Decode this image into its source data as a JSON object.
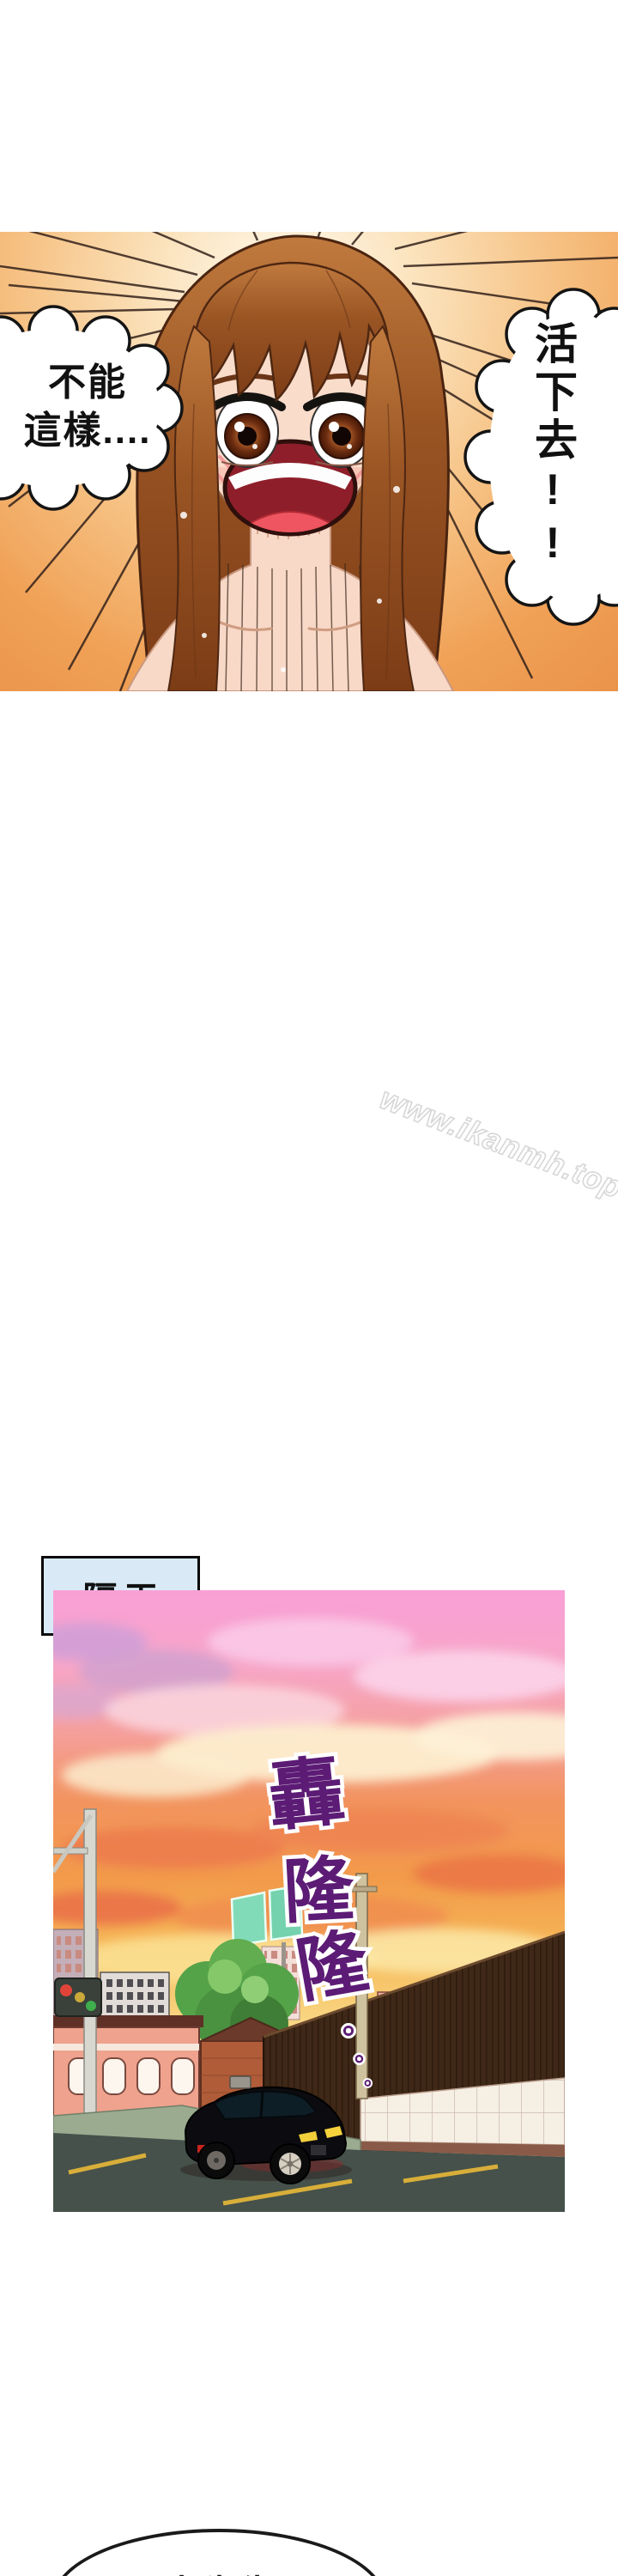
{
  "page": {
    "background": "#ffffff",
    "watermark": "www.ikanmh.top"
  },
  "panel1": {
    "speech_left_line1": "不能",
    "speech_left_line2": "這樣....",
    "speech_right": "活下去!!"
  },
  "scene_label": "隔天",
  "panel2": {
    "sfx_chars": [
      "轟",
      "隆",
      "隆"
    ],
    "sfx_dots": [
      "。",
      "。",
      "。"
    ]
  },
  "bottom_bubble": {
    "text": "王大先生..."
  },
  "colors": {
    "burst_orange": "#f0a156",
    "sky_pink": "#f99fd6",
    "sunset_orange": "#f2945f",
    "sunset_yellow": "#fbe092",
    "sfx_purple": "#5c1b75",
    "label_blue": "#d9eaf6",
    "hair_brown": "#9a5524",
    "car_black": "#0c0c10",
    "road_gray": "#45514a",
    "billboard_teal": "#7fd9b5"
  }
}
